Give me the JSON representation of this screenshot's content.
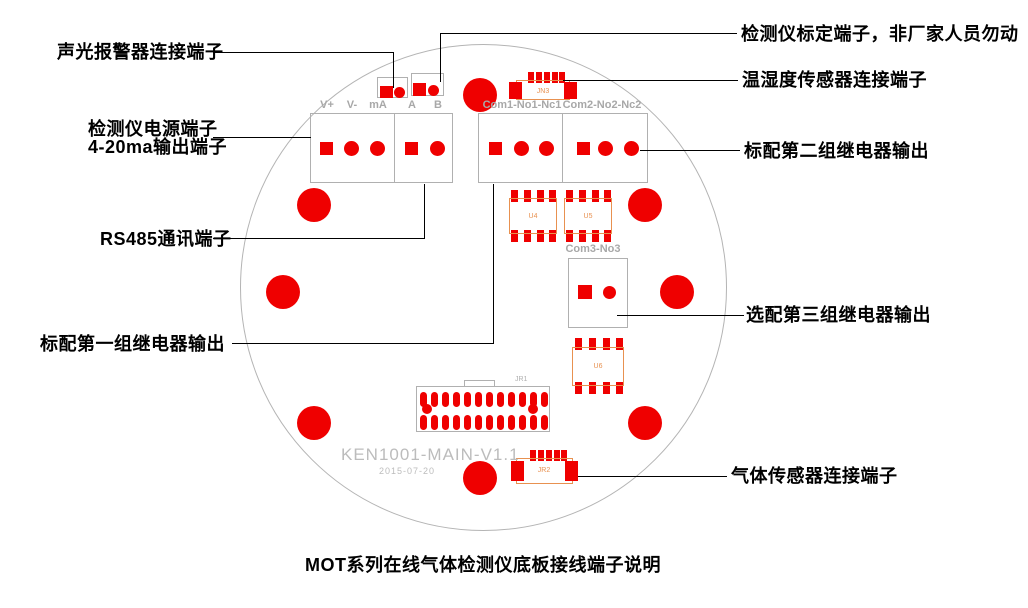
{
  "diagram_title": "MOT系列在线气体检测仪底板接线端子说明",
  "board": {
    "silk_model": "KEN1001-MAIN-V1.1",
    "silk_date": "2015-07-20",
    "terminals": {
      "vplus": "V+",
      "vminus": "V-",
      "ma": "mA",
      "a": "A",
      "b": "B",
      "relay1": "Com1-No1-Nc1",
      "relay2": "Com2-No2-Nc2",
      "relay3": "Com3-No3"
    },
    "components": {
      "jn3": "JN3",
      "jr1": "JR1",
      "jr2": "JR2",
      "u4": "U4",
      "u5": "U5",
      "u6": "U6"
    }
  },
  "callouts": {
    "alarm": "声光报警器连接端子",
    "power": "检测仪电源端子",
    "output420": "4-20ma输出端子",
    "rs485": "RS485通讯端子",
    "relay1": "标配第一组继电器输出",
    "calibration": "检测仪标定端子，非厂家人员勿动",
    "temp_humidity": "温湿度传感器连接端子",
    "relay2": "标配第二组继电器输出",
    "relay3": "选配第三组继电器输出",
    "gas_sensor": "气体传感器连接端子"
  },
  "colors": {
    "pad_red": "#ef0000",
    "outline_gray": "#b0b0b0",
    "component_orange": "#e89150",
    "silk_label_gray": "#a8a8a8",
    "silk_text_gray": "#bcbcbc",
    "callout_black": "#000000"
  }
}
